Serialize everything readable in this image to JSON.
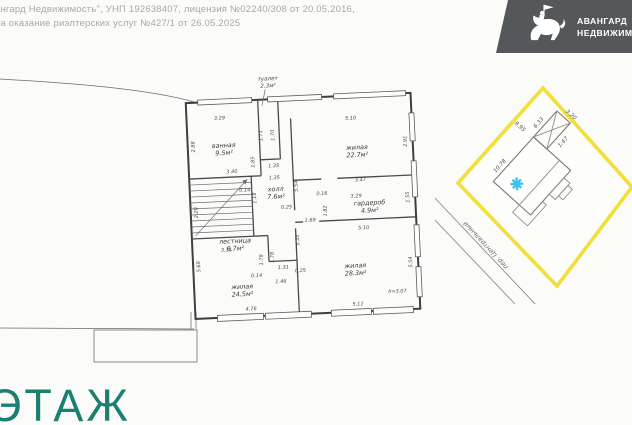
{
  "header": {
    "line1": "ангард Недвижимость\", УНП 192638407, лицензия №02240/308 от 20.05.2016,",
    "line2": "на оказание риэлтерских услуг №427/1 от 26.05.2025"
  },
  "logo": {
    "line1": "АВАНГАРД",
    "line2": "НЕДВИЖИМ",
    "background_color": "#55585a",
    "icon": "knight-on-horseback"
  },
  "floor_label": "ЭТАЖ",
  "floor_label_color": "#1b8070",
  "floor_plan": {
    "height_note": "h=3.07",
    "toilet_callout": {
      "name": "туалет",
      "area": "2.3м²"
    },
    "rooms": [
      {
        "name": "ванная",
        "area": "9.5м²",
        "x": 50,
        "y": 82
      },
      {
        "name": "жилая",
        "area": "22.7м²",
        "x": 183,
        "y": 90
      },
      {
        "name": "холл",
        "area": "7.6м²",
        "x": 100,
        "y": 128
      },
      {
        "name": "гардероб",
        "area": "4.9м²",
        "x": 193,
        "y": 146
      },
      {
        "name": "лестница",
        "area": "6.7м²",
        "x": 57,
        "y": 178
      },
      {
        "name": "жилая",
        "area": "24.5м²",
        "x": 62,
        "y": 224
      },
      {
        "name": "жилая",
        "area": "28.3м²",
        "x": 176,
        "y": 208
      }
    ],
    "dimensions": [
      {
        "text": "3.29",
        "x": 47,
        "y": 54
      },
      {
        "text": "5.10",
        "x": 178,
        "y": 60
      },
      {
        "text": "1.71",
        "x": 89,
        "y": 72,
        "rot": -90
      },
      {
        "text": "1.70",
        "x": 101,
        "y": 72,
        "rot": -90
      },
      {
        "text": "2.88",
        "x": 21,
        "y": 80,
        "rot": -90
      },
      {
        "text": "1.85",
        "x": 80,
        "y": 98,
        "rot": -90
      },
      {
        "text": "3.40",
        "x": 57,
        "y": 108
      },
      {
        "text": "1.35",
        "x": 99,
        "y": 104
      },
      {
        "text": "1.35",
        "x": 99,
        "y": 116
      },
      {
        "text": "2.91",
        "x": 233,
        "y": 84,
        "rot": -90
      },
      {
        "text": "5.54",
        "x": 122,
        "y": 124,
        "rot": -90
      },
      {
        "text": "0.14",
        "x": 69,
        "y": 127
      },
      {
        "text": "1.18",
        "x": 80,
        "y": 134,
        "rot": -90
      },
      {
        "text": "0.25",
        "x": 110,
        "y": 146
      },
      {
        "text": "3.47",
        "x": 185,
        "y": 122
      },
      {
        "text": "0.16",
        "x": 146,
        "y": 134
      },
      {
        "text": "3.29",
        "x": 180,
        "y": 138
      },
      {
        "text": "1.82",
        "x": 150,
        "y": 150,
        "rot": -90
      },
      {
        "text": "1.55",
        "x": 233,
        "y": 140,
        "rot": -90
      },
      {
        "text": "1.69",
        "x": 133,
        "y": 160
      },
      {
        "text": "5.35",
        "x": 121,
        "y": 178,
        "rot": -90
      },
      {
        "text": "5.10",
        "x": 186,
        "y": 170
      },
      {
        "text": "3.31",
        "x": 48,
        "y": 186
      },
      {
        "text": "2.20",
        "x": 21,
        "y": 146,
        "rot": -90
      },
      {
        "text": "1.79",
        "x": 84,
        "y": 196,
        "rot": -90
      },
      {
        "text": "1.78",
        "x": 95,
        "y": 194,
        "rot": -90
      },
      {
        "text": "1.31",
        "x": 104,
        "y": 206
      },
      {
        "text": "0.14",
        "x": 77,
        "y": 213
      },
      {
        "text": "1.46",
        "x": 101,
        "y": 220
      },
      {
        "text": "0.25",
        "x": 121,
        "y": 210
      },
      {
        "text": "5.69",
        "x": 21,
        "y": 200,
        "rot": -90
      },
      {
        "text": "5.54",
        "x": 233,
        "y": 205,
        "rot": -90
      },
      {
        "text": "4.76",
        "x": 70,
        "y": 246
      },
      {
        "text": "5.11",
        "x": 177,
        "y": 246
      },
      {
        "text": "h=3.07",
        "x": 217,
        "y": 235
      }
    ]
  },
  "site_plan": {
    "boundary_color": "#f2df3a",
    "marker_color": "#3bc3ee",
    "street_label": "пер. Центральный",
    "dimensions": [
      {
        "text": "10.78",
        "x": -14,
        "y": -29,
        "rot": 0
      },
      {
        "text": "8.95",
        "x": 27,
        "y": -42,
        "rot": 90
      },
      {
        "text": "6.33",
        "x": 44,
        "y": -29,
        "rot": 0
      },
      {
        "text": "3.20",
        "x": 70,
        "y": -12,
        "rot": 90
      },
      {
        "text": "1.47",
        "x": 46,
        "y": 2,
        "rot": 0
      }
    ]
  }
}
